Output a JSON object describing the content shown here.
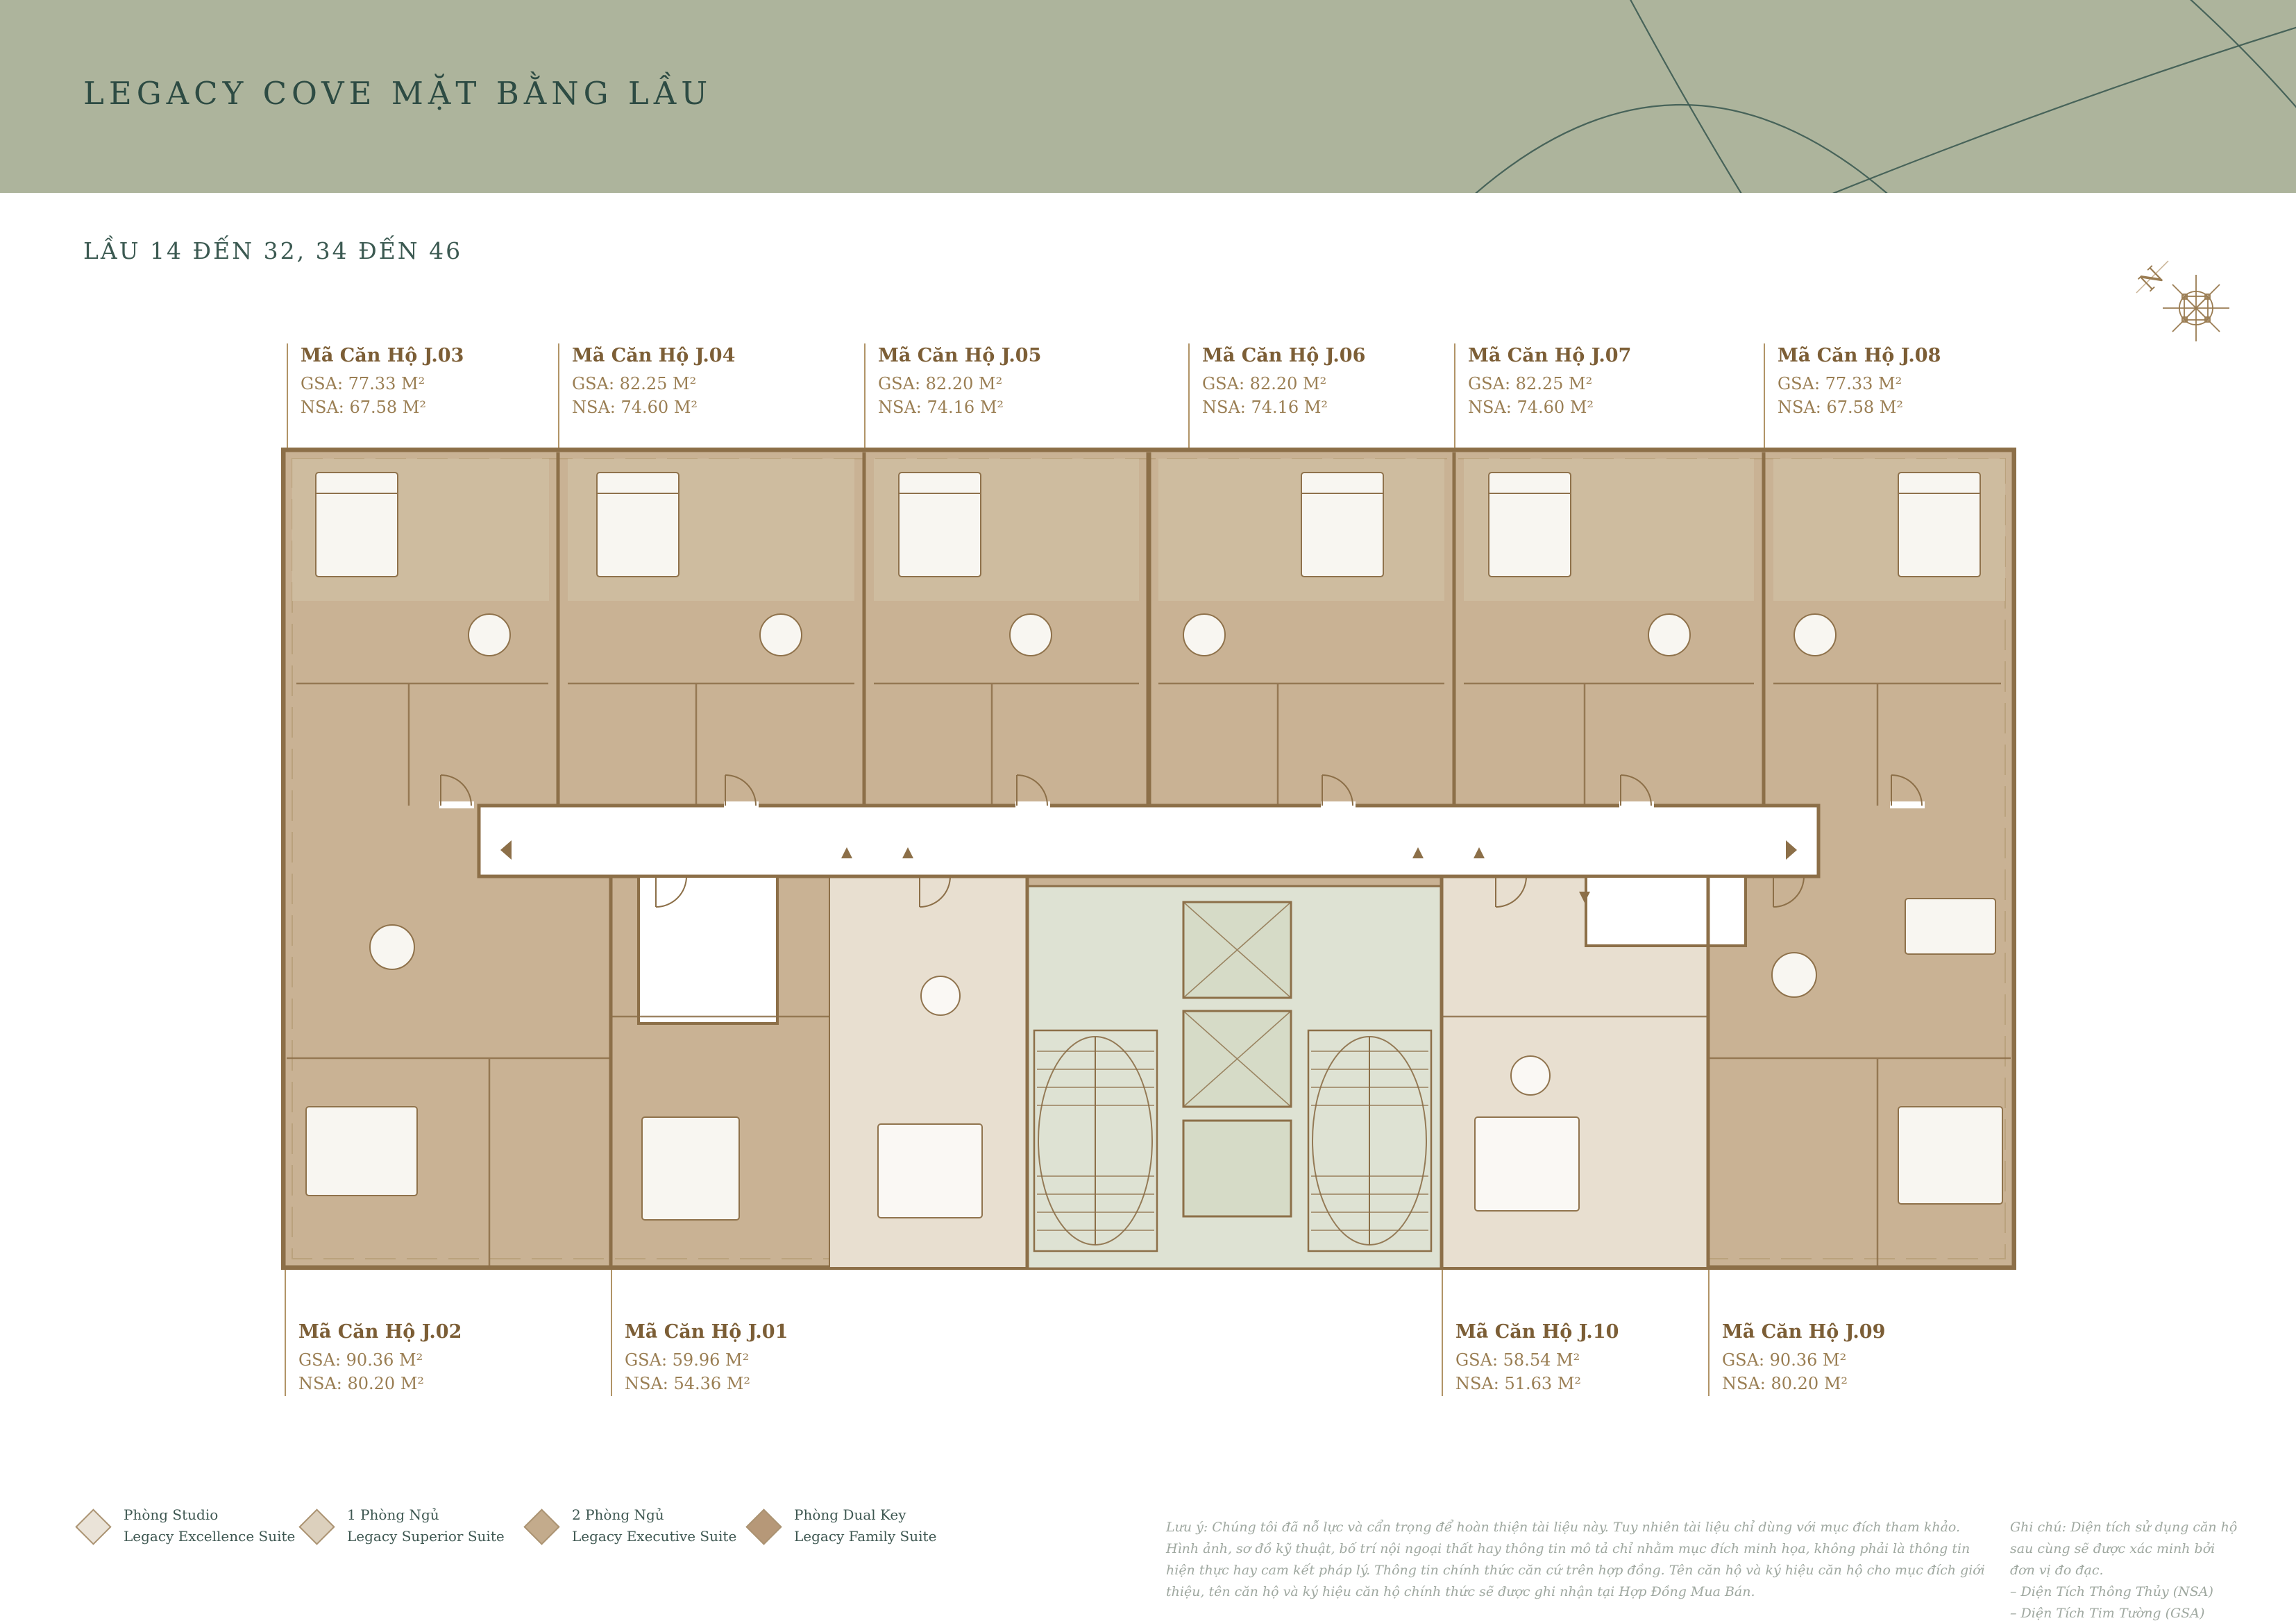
{
  "page": {
    "title": "LEGACY COVE MẶT BẰNG LẦU",
    "subtitle": "LẦU 14 ĐẾN 32, 34 ĐẾN 46"
  },
  "compass": {
    "north_label": "N"
  },
  "units_top": [
    {
      "code": "Mã Căn Hộ J.03",
      "gsa": "GSA: 77.33 M²",
      "nsa": "NSA: 67.58 M²"
    },
    {
      "code": "Mã Căn Hộ J.04",
      "gsa": "GSA: 82.25 M²",
      "nsa": "NSA: 74.60 M²"
    },
    {
      "code": "Mã Căn Hộ J.05",
      "gsa": "GSA: 82.20 M²",
      "nsa": "NSA: 74.16 M²"
    },
    {
      "code": "Mã Căn Hộ J.06",
      "gsa": "GSA: 82.20 M²",
      "nsa": "NSA: 74.16 M²"
    },
    {
      "code": "Mã Căn Hộ J.07",
      "gsa": "GSA: 82.25 M²",
      "nsa": "NSA: 74.60 M²"
    },
    {
      "code": "Mã Căn Hộ J.08",
      "gsa": "GSA: 77.33 M²",
      "nsa": "NSA: 67.58 M²"
    }
  ],
  "units_bottom": [
    {
      "code": "Mã Căn Hộ J.02",
      "gsa": "GSA: 90.36 M²",
      "nsa": "NSA: 80.20 M²"
    },
    {
      "code": "Mã Căn Hộ J.01",
      "gsa": "GSA: 59.96 M²",
      "nsa": "NSA: 54.36 M²"
    },
    {
      "code": "Mã Căn Hộ J.10",
      "gsa": "GSA: 58.54 M²",
      "nsa": "NSA: 51.63 M²"
    },
    {
      "code": "Mã Căn Hộ J.09",
      "gsa": "GSA: 90.36 M²",
      "nsa": "NSA: 80.20 M²"
    }
  ],
  "legend": {
    "items": [
      {
        "type": "Phòng Studio",
        "suite": "Legacy Excellence Suite",
        "color": "#eae3d8"
      },
      {
        "type": "1 Phòng Ngủ",
        "suite": "Legacy Superior Suite",
        "color": "#dcd0bd"
      },
      {
        "type": "2 Phòng Ngủ",
        "suite": "Legacy Executive Suite",
        "color": "#c3ab8c"
      },
      {
        "type": "Phòng Dual Key",
        "suite": "Legacy Family Suite",
        "color": "#b69878"
      }
    ]
  },
  "notes": {
    "luu_y": "Lưu ý: Chúng tôi đã nỗ lực và cẩn trọng để hoàn thiện tài liệu này. Tuy nhiên tài liệu chỉ dùng với mục đích tham khảo. Hình ảnh, sơ đồ kỹ thuật, bố trí nội ngoại thất hay thông tin mô tả chỉ nhằm mục đích minh họa, không phải là thông tin hiện thực hay cam kết pháp lý. Thông tin chính thức căn cứ trên hợp đồng. Tên căn hộ và ký hiệu căn hộ cho mục đích giới thiệu, tên căn hộ và ký hiệu căn hộ chính thức sẽ được ghi nhận tại Hợp Đồng Mua Bán.",
    "ghi_chu": "Ghi chú: Diện tích sử dụng căn hộ sau cùng sẽ được xác minh bởi đơn vị đo đạc.",
    "ghi_chu_items": [
      "– Diện Tích Thông Thủy (NSA)",
      "– Diện Tích Tim Tường (GSA)"
    ]
  },
  "colors": {
    "header_bg": "#adb49c",
    "title_text": "#2d4b43",
    "wall_brown": "#8c6f48",
    "floor_tan": "#c9b294",
    "floor_cream": "#e8dfd0",
    "core_sage": "#dee2d3",
    "label_brown": "#7c5e36",
    "label_value_brown": "#9a7e53",
    "note_gray": "#9fa8a0",
    "compass_brown": "#9a7c52"
  }
}
